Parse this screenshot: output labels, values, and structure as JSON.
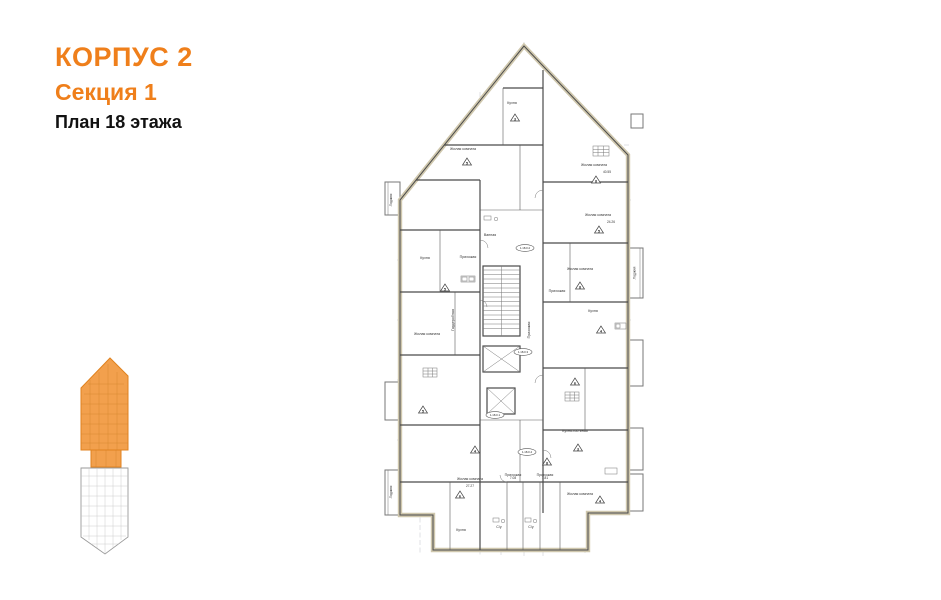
{
  "header": {
    "building": "КОРПУС 2",
    "section": "Секция 1",
    "floor": "План 18 этажа",
    "accent_color": "#ef7f1b"
  },
  "key_plan": {
    "highlighted_section": "Секция 1",
    "highlight_color": "#f2a04d",
    "outline_color": "#e0821f"
  },
  "floor_plan": {
    "wall_color": "#4a4a4a",
    "wall_fill": "#cfc7ad",
    "axis_color": "#b9bcc4",
    "apartment_tags": [
      "1.18.0.1",
      "1.18.0.2",
      "1.18.0.3",
      "1.18.0.4"
    ],
    "unit_markers": [
      "3",
      "5",
      "8",
      "5",
      "5",
      "8",
      "4",
      "5",
      "6",
      "4",
      "3",
      "6",
      "8",
      "4"
    ],
    "rooms": [
      {
        "label": "Кухня",
        "area": ""
      },
      {
        "label": "Жилая комната",
        "area": ""
      },
      {
        "label": "Жилая комната",
        "area": "40.55"
      },
      {
        "label": "Жилая комната",
        "area": "24.26"
      },
      {
        "label": "Кухня",
        "area": ""
      },
      {
        "label": "Прихожая",
        "area": ""
      },
      {
        "label": "Гардеробная",
        "area": ""
      },
      {
        "label": "Жилая комната",
        "area": ""
      },
      {
        "label": "Прихожая",
        "area": ""
      },
      {
        "label": "Кухня",
        "area": ""
      },
      {
        "label": "Кухня-гостиная",
        "area": ""
      },
      {
        "label": "Прихожая",
        "area": ""
      },
      {
        "label": "Жилая комната",
        "area": "27.27"
      },
      {
        "label": "Прихожая",
        "area": "7.08"
      },
      {
        "label": "Прихожая",
        "area": "7.81"
      },
      {
        "label": "Жилая комната",
        "area": ""
      },
      {
        "label": "С/у",
        "area": ""
      },
      {
        "label": "Ванная",
        "area": ""
      },
      {
        "label": "Лоджия",
        "area": ""
      },
      {
        "label": "Лоджия",
        "area": ""
      },
      {
        "label": "Лоджия",
        "area": ""
      },
      {
        "label": "Кухня",
        "area": ""
      },
      {
        "label": "С/у",
        "area": ""
      },
      {
        "label": "Жилая комната",
        "area": ""
      }
    ]
  }
}
